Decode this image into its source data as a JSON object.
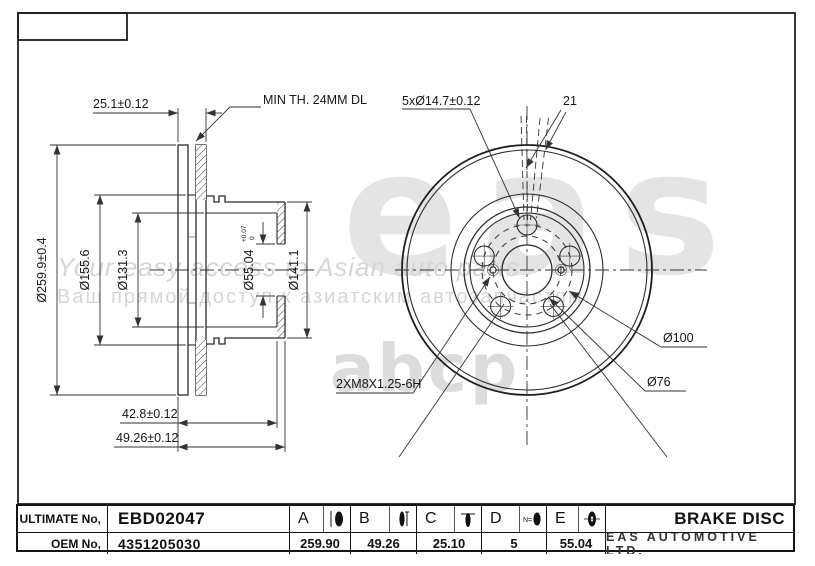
{
  "watermarks": {
    "logo": "eas",
    "portal": "abcp",
    "tagline_en": "Your easy access to Asian auto parts",
    "tagline_ru": "Ваш прямой доступ к азиатским автозапчастям."
  },
  "section_view": {
    "dim_pair_thickness": "25.1±0.12",
    "dim_min_thickness": "MIN TH. 24MM DL",
    "dim_outer_diameter": "Ø259.9±0.4",
    "dim_vent_diameter": "Ø155.6",
    "dim_hat_inner_diameter": "Ø131.3",
    "dim_bore": "Ø55.04",
    "dim_bore_tol_upper": "+0.07",
    "dim_bore_tol_lower": "0",
    "dim_hat_diameter": "Ø141.1",
    "dim_hat_depth": "42.8±0.12",
    "dim_total_height": "49.26±0.12"
  },
  "front_view": {
    "label_bolt_holes": "5xØ14.7±0.12",
    "label_offset": "21",
    "label_bolt_circle": "Ø100",
    "label_thread_circle": "Ø76",
    "label_thread_spec": "2XM8X1.25-6H"
  },
  "title_table": {
    "ultimate_no_label": "ULTIMATE No,",
    "ultimate_no_value": "EBD02047",
    "oem_no_label": "OEM No,",
    "oem_no_value": "4351205030",
    "columns": [
      {
        "letter": "A",
        "value": "259.90",
        "icon": "disc-outer-diameter-icon"
      },
      {
        "letter": "B",
        "value": "49.26",
        "icon": "disc-height-icon"
      },
      {
        "letter": "C",
        "value": "25.10",
        "icon": "disc-thickness-icon"
      },
      {
        "letter": "D",
        "value": "5",
        "icon": "bolt-hole-count-icon"
      },
      {
        "letter": "E",
        "value": "55.04",
        "icon": "center-bore-icon"
      }
    ],
    "part_title": "BRAKE DISC",
    "company": "EAS AUTOMOTIVE LTD."
  }
}
